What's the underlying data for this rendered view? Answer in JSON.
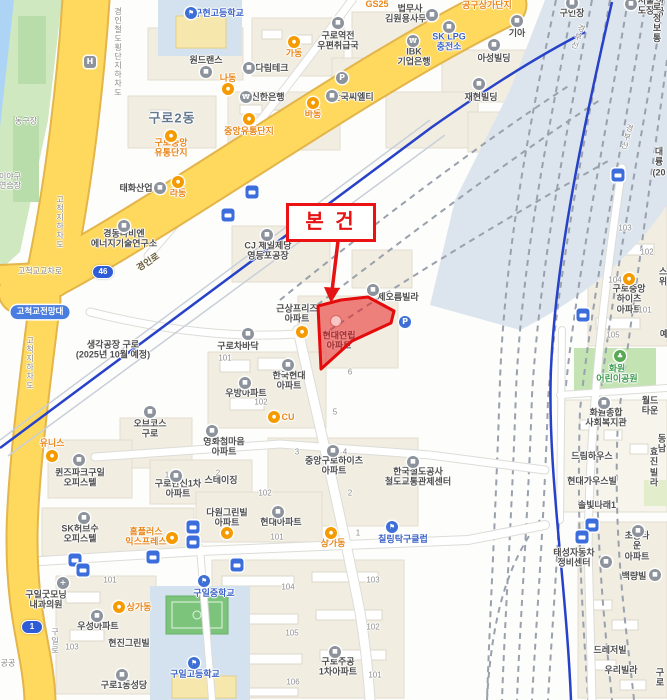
{
  "subject": {
    "label": "본 건",
    "parcel_text": "현대연립\n아파트"
  },
  "colors": {
    "road_yellow": "#ffd95e",
    "road_yellow_casing": "#e3b54a",
    "water": "#aed4f5",
    "green_area": "#c8e6b8",
    "track_bed": "#dce5ee",
    "subway_blue": "#2742c8",
    "subject_red": "#e81111",
    "poi_orange": "#e8861a",
    "poi_blue": "#3d63c6"
  },
  "shields": [
    {
      "t": "46",
      "x": 103,
      "y": 272
    },
    {
      "t": "1",
      "x": 32,
      "y": 627
    }
  ],
  "labels": [
    {
      "n": "poi-school",
      "t": "구현고등학교",
      "x": 219,
      "y": 13,
      "k": "pb"
    },
    {
      "n": "poi-label",
      "t": "원드랜스",
      "x": 206,
      "y": 60,
      "k": "p"
    },
    {
      "n": "poi-label",
      "t": "다림테크",
      "x": 272,
      "y": 68,
      "k": "p"
    },
    {
      "n": "poi-label",
      "t": "신한은행",
      "x": 268,
      "y": 97,
      "k": "p"
    },
    {
      "n": "poi-label",
      "t": "구로역전\n우편취급국",
      "x": 338,
      "y": 41,
      "k": "p"
    },
    {
      "n": "poi-label",
      "t": "법무사\n김원용사무소",
      "x": 410,
      "y": 14,
      "k": "p"
    },
    {
      "n": "poi-label",
      "t": "기아",
      "x": 517,
      "y": 33,
      "k": "p"
    },
    {
      "n": "poi-label",
      "t": "SK LPG\n충전소",
      "x": 449,
      "y": 42,
      "k": "pb"
    },
    {
      "n": "poi-label",
      "t": "아성빌딩",
      "x": 494,
      "y": 58,
      "k": "p"
    },
    {
      "n": "poi-label",
      "t": "IBK\n기업은행",
      "x": 414,
      "y": 57,
      "k": "p"
    },
    {
      "n": "poi-label",
      "t": "재현빌딩",
      "x": 481,
      "y": 97,
      "k": "p"
    },
    {
      "n": "poi-label",
      "t": "한국씨엘티",
      "x": 353,
      "y": 97,
      "k": "p"
    },
    {
      "n": "poi-label",
      "t": "구인장",
      "x": 572,
      "y": 13,
      "k": "p"
    },
    {
      "n": "poi-label",
      "t": "서울도장",
      "x": 646,
      "y": 6,
      "k": "p"
    },
    {
      "n": "clipped-label",
      "t": "한국",
      "x": 660,
      "y": 7,
      "k": "p"
    },
    {
      "n": "clipped-label",
      "t": "구로정보통",
      "x": 657,
      "y": 18,
      "k": "p"
    },
    {
      "n": "poi-label",
      "t": "GS25",
      "x": 377,
      "y": 4,
      "k": "o"
    },
    {
      "n": "poi-label",
      "t": "공구상가단지",
      "x": 487,
      "y": 5,
      "k": "o"
    },
    {
      "n": "poi-label",
      "t": "가동",
      "x": 294,
      "y": 53,
      "k": "o"
    },
    {
      "n": "poi-label",
      "t": "나동",
      "x": 228,
      "y": 78,
      "k": "o"
    },
    {
      "n": "poi-label",
      "t": "바동",
      "x": 313,
      "y": 114,
      "k": "o"
    },
    {
      "n": "poi-label",
      "t": "중앙유통단지",
      "x": 249,
      "y": 131,
      "k": "o"
    },
    {
      "n": "poi-label",
      "t": "구로중앙\n유통단지",
      "x": 171,
      "y": 148,
      "k": "o"
    },
    {
      "n": "district-label",
      "t": "구로2동",
      "x": 172,
      "y": 119,
      "k": "a"
    },
    {
      "n": "area-label",
      "t": "농구장",
      "x": 26,
      "y": 121,
      "k": "r"
    },
    {
      "n": "clipped-label",
      "t": "이야구\n연습장",
      "x": 10,
      "y": 181,
      "k": "r"
    },
    {
      "n": "poi-label",
      "t": "태화산업",
      "x": 136,
      "y": 188,
      "k": "p"
    },
    {
      "n": "poi-label",
      "t": "라동",
      "x": 178,
      "y": 193,
      "k": "o"
    },
    {
      "n": "poi-label",
      "t": "경동나비엔\n에너지기술연구소",
      "x": 124,
      "y": 239,
      "k": "p"
    },
    {
      "n": "poi-label",
      "t": "CJ 제일제당\n영등포공장",
      "x": 268,
      "y": 251,
      "k": "p"
    },
    {
      "n": "pill-label",
      "t": "고척교전망대",
      "x": 40,
      "y": 312,
      "k": "pill"
    },
    {
      "n": "poi-label",
      "t": "생각공장 구로\n(2025년 10월 예정)",
      "x": 113,
      "y": 350,
      "k": "p"
    },
    {
      "n": "poi-label",
      "t": "근상프리즈\n아파트",
      "x": 297,
      "y": 314,
      "k": "p"
    },
    {
      "n": "poi-label",
      "t": "구로차바닥",
      "x": 238,
      "y": 346,
      "k": "p"
    },
    {
      "n": "poi-label",
      "t": "제오름빌라",
      "x": 398,
      "y": 297,
      "k": "p"
    },
    {
      "n": "subject-parcel-label",
      "t": "현대연립\n아파트",
      "x": 339,
      "y": 341,
      "k": "p"
    },
    {
      "n": "poi-label",
      "t": "한국현대\n아파트",
      "x": 289,
      "y": 381,
      "k": "p"
    },
    {
      "n": "poi-label",
      "t": "우방아파트",
      "x": 246,
      "y": 393,
      "k": "p"
    },
    {
      "n": "poi-label",
      "t": "CU",
      "x": 288,
      "y": 417,
      "k": "o"
    },
    {
      "n": "poi-label",
      "t": "영화첨마음\n아파트",
      "x": 224,
      "y": 447,
      "k": "p"
    },
    {
      "n": "poi-label",
      "t": "구로한신1차\n아파트",
      "x": 178,
      "y": 489,
      "k": "p"
    },
    {
      "n": "poi-label",
      "t": "스테이징",
      "x": 221,
      "y": 480,
      "k": "p"
    },
    {
      "n": "poi-label",
      "t": "중앙구로하이츠\n아파트",
      "x": 334,
      "y": 466,
      "k": "p"
    },
    {
      "n": "poi-label",
      "t": "한국철도공사\n철도교통관제센터",
      "x": 418,
      "y": 477,
      "k": "p"
    },
    {
      "n": "poi-label",
      "t": "오브코스\n구로",
      "x": 150,
      "y": 429,
      "k": "p"
    },
    {
      "n": "poi-label",
      "t": "유니스",
      "x": 52,
      "y": 443,
      "k": "o"
    },
    {
      "n": "poi-label",
      "t": "퀸즈파크구일\n오피스텔",
      "x": 80,
      "y": 478,
      "k": "p"
    },
    {
      "n": "poi-label",
      "t": "SK허브수\n오피스텔",
      "x": 80,
      "y": 534,
      "k": "p"
    },
    {
      "n": "poi-label",
      "t": "홈플러스\n익스프레스",
      "x": 146,
      "y": 537,
      "k": "o"
    },
    {
      "n": "poi-label",
      "t": "구일굿모닝\n내과의원",
      "x": 46,
      "y": 600,
      "k": "p"
    },
    {
      "n": "poi-label",
      "t": "상가동",
      "x": 139,
      "y": 607,
      "k": "o"
    },
    {
      "n": "poi-label",
      "t": "우성아파트",
      "x": 98,
      "y": 626,
      "k": "p"
    },
    {
      "n": "poi-label",
      "t": "현진그린빌",
      "x": 129,
      "y": 643,
      "k": "p"
    },
    {
      "n": "poi-label",
      "t": "구로1동성당",
      "x": 124,
      "y": 685,
      "k": "p"
    },
    {
      "n": "poi-school",
      "t": "구일중학교",
      "x": 214,
      "y": 593,
      "k": "pb"
    },
    {
      "n": "poi-school",
      "t": "구일고등학교",
      "x": 195,
      "y": 674,
      "k": "pb"
    },
    {
      "n": "poi-label",
      "t": "다원그린빌\n아파트",
      "x": 227,
      "y": 518,
      "k": "p"
    },
    {
      "n": "poi-label",
      "t": "현대아파트",
      "x": 281,
      "y": 522,
      "k": "p"
    },
    {
      "n": "poi-label",
      "t": "상가동",
      "x": 333,
      "y": 543,
      "k": "o"
    },
    {
      "n": "poi-label",
      "t": "칠링탁구클럽",
      "x": 403,
      "y": 539,
      "k": "pb"
    },
    {
      "n": "poi-label",
      "t": "구로주공\n1차아파트",
      "x": 338,
      "y": 667,
      "k": "p"
    },
    {
      "n": "poi-label",
      "t": "구로중앙하이츠\n아파트",
      "x": 629,
      "y": 299,
      "k": "p"
    },
    {
      "n": "poi-park",
      "t": "화원\n어린이공원",
      "x": 617,
      "y": 374,
      "k": "g"
    },
    {
      "n": "poi-label",
      "t": "화원종합\n사회복지관",
      "x": 606,
      "y": 418,
      "k": "p"
    },
    {
      "n": "poi-label",
      "t": "월드타운",
      "x": 650,
      "y": 406,
      "k": "p"
    },
    {
      "n": "poi-label",
      "t": "드림하우스",
      "x": 592,
      "y": 456,
      "k": "p"
    },
    {
      "n": "clipped-label",
      "t": "효진빌라",
      "x": 654,
      "y": 467,
      "k": "p"
    },
    {
      "n": "poi-label",
      "t": "현대가우스빌",
      "x": 592,
      "y": 481,
      "k": "p"
    },
    {
      "n": "poi-label",
      "t": "솔빛나래1",
      "x": 597,
      "y": 505,
      "k": "p"
    },
    {
      "n": "poi-label",
      "t": "태성자동차\n정비센터",
      "x": 574,
      "y": 558,
      "k": "p"
    },
    {
      "n": "poi-label",
      "t": "초롱타운\n아파트",
      "x": 637,
      "y": 546,
      "k": "p"
    },
    {
      "n": "poi-label",
      "t": "백량빌",
      "x": 634,
      "y": 576,
      "k": "p"
    },
    {
      "n": "poi-label",
      "t": "드레저빌",
      "x": 610,
      "y": 650,
      "k": "p"
    },
    {
      "n": "poi-label",
      "t": "우리빌라",
      "x": 621,
      "y": 670,
      "k": "p"
    },
    {
      "n": "clipped-label",
      "t": "구로",
      "x": 660,
      "y": 678,
      "k": "p"
    },
    {
      "n": "clipped-label",
      "t": "대륭\n(20",
      "x": 659,
      "y": 162,
      "k": "p"
    },
    {
      "n": "clipped-label",
      "t": "동남",
      "x": 662,
      "y": 444,
      "k": "p"
    },
    {
      "n": "clipped-label",
      "t": "스위",
      "x": 663,
      "y": 277,
      "k": "p"
    },
    {
      "n": "clipped-label",
      "t": "예",
      "x": 664,
      "y": 334,
      "k": "p"
    },
    {
      "n": "clipped-label",
      "t": "공공",
      "x": 8,
      "y": 663,
      "k": "r"
    },
    {
      "n": "building-number",
      "t": "101",
      "x": 225,
      "y": 358,
      "k": "n"
    },
    {
      "n": "building-number",
      "t": "102",
      "x": 261,
      "y": 402,
      "k": "n"
    },
    {
      "n": "building-number",
      "t": "6",
      "x": 350,
      "y": 372,
      "k": "n"
    },
    {
      "n": "building-number",
      "t": "5",
      "x": 335,
      "y": 412,
      "k": "n"
    },
    {
      "n": "building-number",
      "t": "3",
      "x": 297,
      "y": 452,
      "k": "n"
    },
    {
      "n": "building-number",
      "t": "4",
      "x": 345,
      "y": 452,
      "k": "n"
    },
    {
      "n": "building-number",
      "t": "2",
      "x": 350,
      "y": 493,
      "k": "n"
    },
    {
      "n": "building-number",
      "t": "1",
      "x": 358,
      "y": 533,
      "k": "n"
    },
    {
      "n": "building-number",
      "t": "2",
      "x": 218,
      "y": 473,
      "k": "n"
    },
    {
      "n": "building-number",
      "t": "1",
      "x": 167,
      "y": 475,
      "k": "n"
    },
    {
      "n": "building-number",
      "t": "102",
      "x": 265,
      "y": 493,
      "k": "n"
    },
    {
      "n": "building-number",
      "t": "101",
      "x": 277,
      "y": 537,
      "k": "n"
    },
    {
      "n": "building-number",
      "t": "101",
      "x": 110,
      "y": 580,
      "k": "n"
    },
    {
      "n": "building-number",
      "t": "103",
      "x": 72,
      "y": 647,
      "k": "n"
    },
    {
      "n": "building-number",
      "t": "104",
      "x": 288,
      "y": 587,
      "k": "n"
    },
    {
      "n": "building-number",
      "t": "103",
      "x": 373,
      "y": 580,
      "k": "n"
    },
    {
      "n": "building-number",
      "t": "105",
      "x": 292,
      "y": 633,
      "k": "n"
    },
    {
      "n": "building-number",
      "t": "102",
      "x": 373,
      "y": 627,
      "k": "n"
    },
    {
      "n": "building-number",
      "t": "106",
      "x": 293,
      "y": 682,
      "k": "n"
    },
    {
      "n": "building-number",
      "t": "101",
      "x": 375,
      "y": 675,
      "k": "n"
    },
    {
      "n": "building-number",
      "t": "103",
      "x": 625,
      "y": 228,
      "k": "n"
    },
    {
      "n": "building-number",
      "t": "102",
      "x": 647,
      "y": 252,
      "k": "n"
    },
    {
      "n": "building-number",
      "t": "104",
      "x": 615,
      "y": 280,
      "k": "n"
    },
    {
      "n": "building-number",
      "t": "101",
      "x": 645,
      "y": 310,
      "k": "n"
    },
    {
      "n": "building-number",
      "t": "105",
      "x": 613,
      "y": 335,
      "k": "n"
    },
    {
      "n": "road-label",
      "t": "경인로",
      "x": 148,
      "y": 262,
      "rot": -33,
      "k": "ry"
    },
    {
      "n": "road-label",
      "t": "경인철도횡단지하차도",
      "x": 118,
      "y": 52,
      "k": "rv"
    },
    {
      "n": "road-label",
      "t": "고척지하차도",
      "x": 60,
      "y": 222,
      "k": "rv"
    },
    {
      "n": "road-label",
      "t": "고척지하차도",
      "x": 30,
      "y": 363,
      "k": "rv"
    },
    {
      "n": "road-label",
      "t": "구일로",
      "x": 55,
      "y": 641,
      "k": "rv"
    },
    {
      "n": "rail-label",
      "t": "경부선",
      "x": 578,
      "y": 37,
      "rot": 20,
      "k": "rv"
    },
    {
      "n": "rail-label",
      "t": "경부선",
      "x": 627,
      "y": 137,
      "rot": 15,
      "k": "rv"
    },
    {
      "n": "intersection-label",
      "t": "고척교교차로",
      "x": 40,
      "y": 271,
      "k": "r"
    }
  ],
  "icons": [
    {
      "kind": "bus",
      "x": 252,
      "y": 192
    },
    {
      "kind": "bus",
      "x": 228,
      "y": 215
    },
    {
      "kind": "bus",
      "x": 193,
      "y": 527
    },
    {
      "kind": "bus",
      "x": 193,
      "y": 542
    },
    {
      "kind": "bus",
      "x": 75,
      "y": 560
    },
    {
      "kind": "bus",
      "x": 83,
      "y": 570
    },
    {
      "kind": "bus",
      "x": 153,
      "y": 557
    },
    {
      "kind": "bus",
      "x": 237,
      "y": 565
    },
    {
      "kind": "bus",
      "x": 618,
      "y": 175
    },
    {
      "kind": "bus",
      "x": 583,
      "y": 315
    },
    {
      "kind": "bus",
      "x": 592,
      "y": 525
    },
    {
      "kind": "bus",
      "x": 582,
      "y": 537
    },
    {
      "kind": "blue",
      "x": 191,
      "y": 13
    },
    {
      "kind": "blue",
      "x": 204,
      "y": 581
    },
    {
      "kind": "blue",
      "x": 194,
      "y": 663
    },
    {
      "kind": "blue",
      "x": 392,
      "y": 527
    },
    {
      "kind": "gray",
      "x": 206,
      "y": 72
    },
    {
      "kind": "gray",
      "x": 249,
      "y": 68
    },
    {
      "kind": "gray",
      "x": 338,
      "y": 23
    },
    {
      "kind": "gray",
      "x": 432,
      "y": 15
    },
    {
      "kind": "gray",
      "x": 517,
      "y": 21
    },
    {
      "kind": "gray",
      "x": 449,
      "y": 27
    },
    {
      "kind": "gray",
      "x": 494,
      "y": 45
    },
    {
      "kind": "gray",
      "x": 479,
      "y": 84
    },
    {
      "kind": "gray",
      "x": 332,
      "y": 96
    },
    {
      "kind": "gray",
      "x": 572,
      "y": 3
    },
    {
      "kind": "gray",
      "x": 631,
      "y": 4
    },
    {
      "kind": "gray",
      "x": 160,
      "y": 188
    },
    {
      "kind": "gray",
      "x": 124,
      "y": 226
    },
    {
      "kind": "gray",
      "x": 267,
      "y": 235
    },
    {
      "kind": "gray",
      "x": 288,
      "y": 365
    },
    {
      "kind": "gray",
      "x": 245,
      "y": 383
    },
    {
      "kind": "gray",
      "x": 212,
      "y": 431
    },
    {
      "kind": "gray",
      "x": 176,
      "y": 476
    },
    {
      "kind": "gray",
      "x": 333,
      "y": 451
    },
    {
      "kind": "gray",
      "x": 413,
      "y": 462
    },
    {
      "kind": "gray",
      "x": 150,
      "y": 412
    },
    {
      "kind": "gray",
      "x": 79,
      "y": 460
    },
    {
      "kind": "gray",
      "x": 84,
      "y": 518
    },
    {
      "kind": "gray",
      "x": 97,
      "y": 616
    },
    {
      "kind": "gray",
      "x": 122,
      "y": 675
    },
    {
      "kind": "gray",
      "x": 278,
      "y": 512
    },
    {
      "kind": "gray",
      "x": 335,
      "y": 652
    },
    {
      "kind": "gray",
      "x": 604,
      "y": 403
    },
    {
      "kind": "gray",
      "x": 606,
      "y": 562
    },
    {
      "kind": "gray",
      "x": 638,
      "y": 531
    },
    {
      "kind": "gray",
      "x": 655,
      "y": 575
    },
    {
      "kind": "gray",
      "x": 373,
      "y": 290
    },
    {
      "kind": "gray",
      "x": 248,
      "y": 334
    },
    {
      "kind": "bank",
      "x": 246,
      "y": 97
    },
    {
      "kind": "bank",
      "x": 413,
      "y": 41
    },
    {
      "kind": "orange",
      "x": 294,
      "y": 42
    },
    {
      "kind": "orange",
      "x": 228,
      "y": 89
    },
    {
      "kind": "orange",
      "x": 313,
      "y": 103
    },
    {
      "kind": "orange",
      "x": 249,
      "y": 119
    },
    {
      "kind": "orange",
      "x": 171,
      "y": 136
    },
    {
      "kind": "orange",
      "x": 178,
      "y": 182
    },
    {
      "kind": "orange",
      "x": 302,
      "y": 332
    },
    {
      "kind": "orange",
      "x": 274,
      "y": 417
    },
    {
      "kind": "orange",
      "x": 52,
      "y": 456
    },
    {
      "kind": "orange",
      "x": 172,
      "y": 538
    },
    {
      "kind": "orange",
      "x": 119,
      "y": 607
    },
    {
      "kind": "orange",
      "x": 331,
      "y": 533
    },
    {
      "kind": "orange",
      "x": 227,
      "y": 533
    },
    {
      "kind": "orange",
      "x": 629,
      "y": 279
    },
    {
      "kind": "green",
      "x": 620,
      "y": 356
    },
    {
      "kind": "pkb",
      "x": 405,
      "y": 322
    },
    {
      "kind": "pkg",
      "x": 342,
      "y": 78
    },
    {
      "kind": "h",
      "x": 90,
      "y": 62
    },
    {
      "kind": "cross",
      "x": 63,
      "y": 583
    }
  ]
}
